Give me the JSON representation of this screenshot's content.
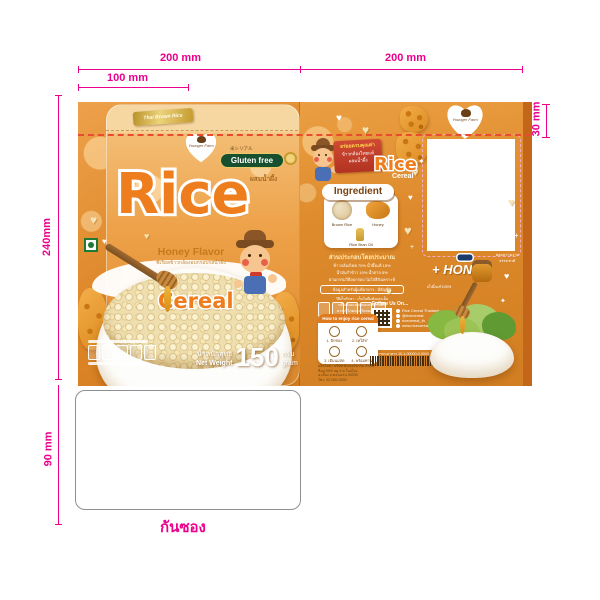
{
  "dimensions": {
    "top_left_width": "200 mm",
    "top_right_width": "200 mm",
    "front_half_width": "100 mm",
    "panel_height": "240mm",
    "gusset_height": "90 mm",
    "top_flap_height": "30 mm"
  },
  "gusset_label": "กันซอง",
  "front": {
    "top_ribbon": "Thai Brown Rice",
    "brand_logo_text": "Younger Farm",
    "jp_text": "米シリアル",
    "gluten_free_label": "Gluten free",
    "honey_mix_thai": "ผสมน้ำผึ้ง",
    "title": "Rice",
    "subtitle": "Cereal",
    "flavor": "Honey Flavor",
    "flavor_sub_thai": "ซีเรียลข้าวกล้องอบกรอบรสน้ำผึ้ง",
    "net_weight_thai": "น้ำหนักสุทธิ",
    "net_weight_en": "Net Weight",
    "net_weight_value": "150",
    "net_unit_thai": "กรัม",
    "net_unit_en": "gram"
  },
  "back": {
    "ribbon_line1": "อร่อยครบคุณค่า",
    "ribbon_line2": "ข้าวกล้องไทยแท้",
    "ribbon_line3": "ผสมน้ำผึ้ง",
    "logo_title": "Rice",
    "logo_subtitle": "Cereal",
    "ingredient_heading": "Ingredient",
    "ingredients": [
      "Brown Rice",
      "Honey",
      "Rice Bran Oil"
    ],
    "composition_heading": "ส่วนประกอบโดยประมาณ",
    "composition_lines": [
      "ข้าวกล้องไทย 70% น้ำผึ้งแท้ 15%",
      "น้ำมันรำข้าว 10% น้ำตาล 5%",
      "ผ่านกรรมวิธีอบกรอบ ไม่ใส่สีสังเคราะห์"
    ],
    "info_box_line": "ข้อมูลสำหรับผู้แพ้อาหาร : มีธัญพืช",
    "storage_lines": [
      "วิธีเก็บรักษา : เก็บในที่แห้งและเย็น",
      "หลีกเลี่ยงแสงแดดและความชื้น",
      "ควรบริโภคก่อนวันหมดอายุที่ระบุ",
      "ผลิตภัณฑ์อาจมีสีแตกต่างตามธรรมชาติ"
    ],
    "follow_heading": "Follow Us On...",
    "social_lines": [
      "Rice Cereal Thailand",
      "@ricecereal",
      "ricecereal_th",
      "www.ricecereal.co.th"
    ],
    "howto_heading": "How to enjoy rice cereal",
    "howto_steps": [
      "1. ฉีกซอง",
      "2. เทใส่ชาม",
      "3. เติมนมสด",
      "4. พร้อมทาน"
    ],
    "honey_label": "+ HONEY",
    "callout_left": "น้ำผึ้งแท้ 100%",
    "callout_right": "หอมหวานจากธรรมชาติ",
    "barcode_note": "เลขสารบบอาหาร 10-1-00000-0-0000",
    "manufacturer_lines": [
      "ผลิตโดย : บริษัท ยังเกอร์ฟาร์ม จำกัด",
      "ที่อยู่ 99/9 หมู่ 9 ต.ในเมือง",
      "อ.เมือง จ.ขอนแก่น 40000",
      "โทร. 02-000-0000"
    ]
  }
}
